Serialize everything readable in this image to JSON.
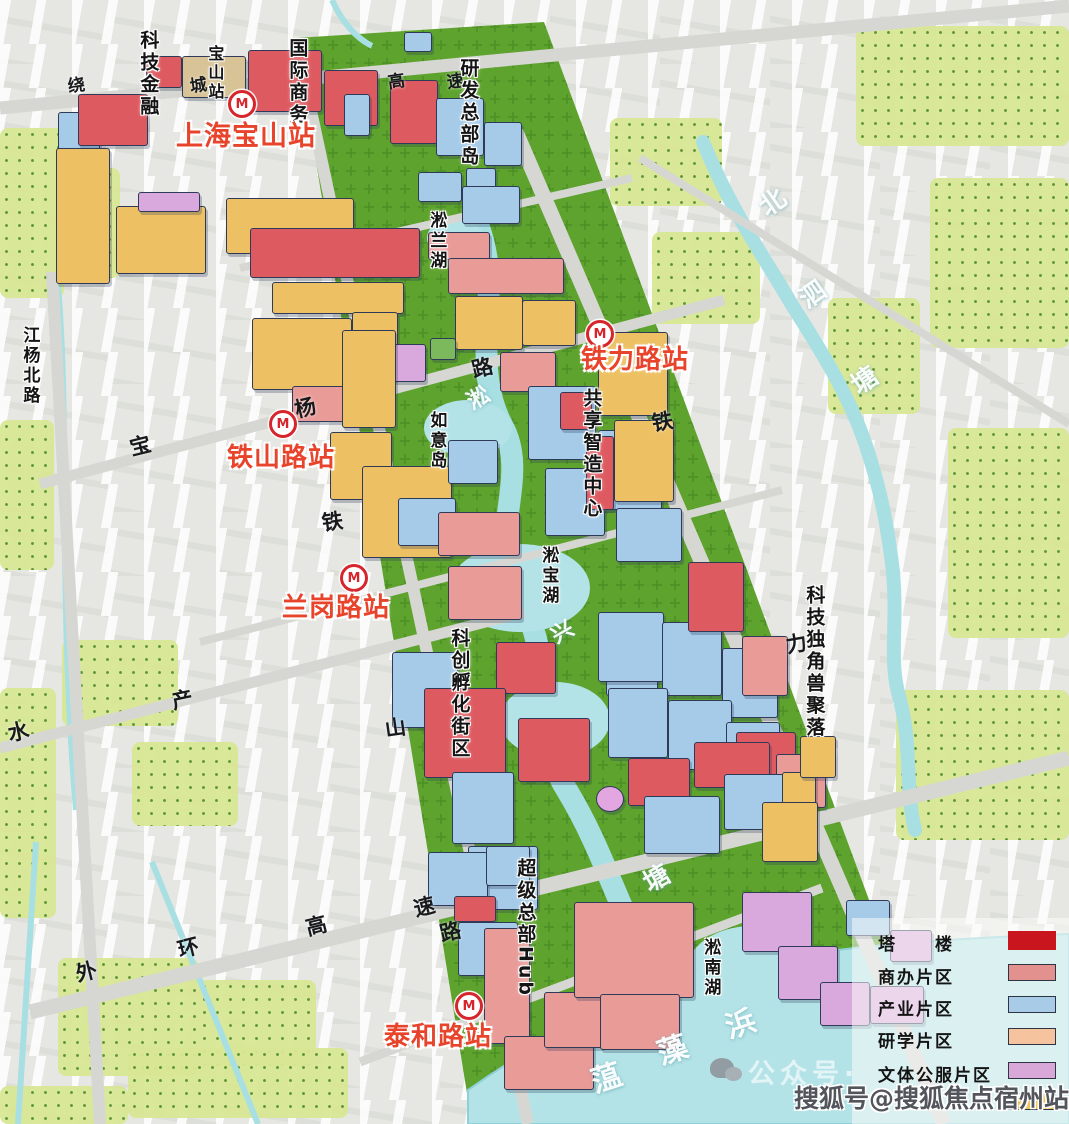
{
  "colors": {
    "tower_red": "#c9151e",
    "commercial_salmon": "#e2918f",
    "industry_blue": "#a8cce8",
    "research_peach": "#f5c39e",
    "culture_purple": "#d8a9d8",
    "yellow_block": "#edc163",
    "station_label_red": "#e8432b",
    "park_green": "#5ea32d",
    "water_cyan": "#b3e3e7"
  },
  "stations": [
    {
      "name": "上海宝山站",
      "icon": {
        "x": 242,
        "y": 104
      },
      "label": {
        "x": 176,
        "y": 123,
        "size": 27
      }
    },
    {
      "name": "铁力路站",
      "icon": {
        "x": 600,
        "y": 334
      },
      "label": {
        "x": 581,
        "y": 347,
        "size": 26
      }
    },
    {
      "name": "铁山路站",
      "icon": {
        "x": 283,
        "y": 424
      },
      "label": {
        "x": 227,
        "y": 445,
        "size": 26
      }
    },
    {
      "name": "兰岗路站",
      "icon": {
        "x": 354,
        "y": 578
      },
      "label": {
        "x": 282,
        "y": 595,
        "size": 26
      }
    },
    {
      "name": "泰和路站",
      "icon": {
        "x": 469,
        "y": 1006
      },
      "label": {
        "x": 384,
        "y": 1024,
        "size": 26
      }
    }
  ],
  "map": {
    "area_labels": [
      {
        "text": "科技金融",
        "x": 138,
        "y": 30,
        "size": 19
      },
      {
        "text": "宝山站",
        "x": 206,
        "y": 45,
        "size": 16
      },
      {
        "text": "国际商务",
        "x": 287,
        "y": 38,
        "size": 19
      },
      {
        "text": "研发总部岛",
        "x": 458,
        "y": 58,
        "size": 19
      },
      {
        "text": "淞兰湖",
        "x": 427,
        "y": 211,
        "size": 17
      },
      {
        "text": "如意岛",
        "x": 427,
        "y": 411,
        "size": 17
      },
      {
        "text": "共享智造中心",
        "x": 581,
        "y": 388,
        "size": 19
      },
      {
        "text": "淞宝湖",
        "x": 539,
        "y": 546,
        "size": 17
      },
      {
        "text": "科创孵化街区",
        "x": 449,
        "y": 628,
        "size": 19
      },
      {
        "text": "科技独角兽聚落",
        "x": 804,
        "y": 585,
        "size": 19
      },
      {
        "text": "超级总部Hub",
        "x": 515,
        "y": 858,
        "size": 19
      },
      {
        "text": "淞南湖",
        "x": 701,
        "y": 938,
        "size": 17
      },
      {
        "text": "江杨北路",
        "x": 20,
        "y": 326,
        "size": 17
      }
    ],
    "road_labels": [
      {
        "t": "绕",
        "x": 68,
        "y": 78,
        "r": -8,
        "s": 17
      },
      {
        "t": "城",
        "x": 190,
        "y": 78,
        "r": -8,
        "s": 17
      },
      {
        "t": "高",
        "x": 388,
        "y": 74,
        "r": -8,
        "s": 17
      },
      {
        "t": "速",
        "x": 447,
        "y": 74,
        "r": -8,
        "s": 17
      },
      {
        "t": "宝",
        "x": 130,
        "y": 436,
        "r": -14,
        "s": 21
      },
      {
        "t": "杨",
        "x": 295,
        "y": 398,
        "r": -14,
        "s": 21
      },
      {
        "t": "路",
        "x": 472,
        "y": 358,
        "r": -14,
        "s": 21
      },
      {
        "t": "铁",
        "x": 322,
        "y": 512,
        "r": -8,
        "s": 21
      },
      {
        "t": "山",
        "x": 385,
        "y": 718,
        "r": -8,
        "s": 21
      },
      {
        "t": "铁",
        "x": 652,
        "y": 412,
        "r": -10,
        "s": 21
      },
      {
        "t": "力",
        "x": 786,
        "y": 634,
        "r": -10,
        "s": 21
      },
      {
        "t": "水",
        "x": 8,
        "y": 722,
        "r": -12,
        "s": 21
      },
      {
        "t": "产",
        "x": 172,
        "y": 690,
        "r": -12,
        "s": 21
      },
      {
        "t": "外",
        "x": 76,
        "y": 962,
        "r": -14,
        "s": 21
      },
      {
        "t": "环",
        "x": 178,
        "y": 938,
        "r": -14,
        "s": 21
      },
      {
        "t": "高",
        "x": 306,
        "y": 916,
        "r": -14,
        "s": 21
      },
      {
        "t": "速",
        "x": 414,
        "y": 897,
        "r": -14,
        "s": 21
      },
      {
        "t": "路",
        "x": 440,
        "y": 922,
        "r": -14,
        "s": 21
      }
    ],
    "river_labels": [
      {
        "t": "北",
        "x": 760,
        "y": 190,
        "r": -35,
        "s": 26
      },
      {
        "t": "泗",
        "x": 800,
        "y": 282,
        "r": -35,
        "s": 26
      },
      {
        "t": "塘",
        "x": 852,
        "y": 368,
        "r": -35,
        "s": 26
      },
      {
        "t": "淞",
        "x": 468,
        "y": 388,
        "r": -30,
        "s": 22
      },
      {
        "t": "兴",
        "x": 552,
        "y": 622,
        "r": -30,
        "s": 22
      },
      {
        "t": "塘",
        "x": 644,
        "y": 866,
        "r": -30,
        "s": 26
      },
      {
        "t": "蕰",
        "x": 592,
        "y": 1064,
        "r": -18,
        "s": 30
      },
      {
        "t": "藻",
        "x": 658,
        "y": 1036,
        "r": -18,
        "s": 30
      },
      {
        "t": "浜",
        "x": 726,
        "y": 1010,
        "r": -18,
        "s": 30
      }
    ],
    "fields": [
      [
        0,
        128,
        64,
        170
      ],
      [
        64,
        168,
        56,
        110
      ],
      [
        0,
        420,
        54,
        150
      ],
      [
        0,
        688,
        56,
        230
      ],
      [
        62,
        640,
        116,
        86
      ],
      [
        132,
        742,
        106,
        84
      ],
      [
        58,
        958,
        140,
        118
      ],
      [
        198,
        980,
        118,
        86
      ],
      [
        128,
        1048,
        220,
        70
      ],
      [
        856,
        26,
        213,
        120
      ],
      [
        930,
        178,
        139,
        170
      ],
      [
        828,
        298,
        92,
        116
      ],
      [
        948,
        428,
        121,
        210
      ],
      [
        896,
        690,
        173,
        150
      ],
      [
        0,
        1086,
        128,
        38
      ],
      [
        610,
        118,
        112,
        88
      ],
      [
        652,
        232,
        108,
        92
      ]
    ],
    "buildings": [
      [
        58,
        112,
        42,
        46,
        "B"
      ],
      [
        78,
        94,
        70,
        52,
        "R"
      ],
      [
        146,
        56,
        36,
        32,
        "R"
      ],
      [
        182,
        56,
        64,
        42,
        "T"
      ],
      [
        248,
        50,
        74,
        62,
        "R"
      ],
      [
        324,
        70,
        54,
        56,
        "R"
      ],
      [
        390,
        80,
        48,
        64,
        "R"
      ],
      [
        344,
        94,
        26,
        42,
        "B"
      ],
      [
        404,
        32,
        28,
        20,
        "B"
      ],
      [
        436,
        98,
        48,
        58,
        "B"
      ],
      [
        484,
        122,
        38,
        44,
        "B"
      ],
      [
        466,
        168,
        30,
        40,
        "B"
      ],
      [
        56,
        148,
        54,
        136,
        "Y"
      ],
      [
        116,
        206,
        90,
        68,
        "Y"
      ],
      [
        226,
        198,
        128,
        56,
        "Y"
      ],
      [
        138,
        192,
        62,
        20,
        "P"
      ],
      [
        250,
        228,
        170,
        50,
        "R"
      ],
      [
        272,
        282,
        132,
        32,
        "Y"
      ],
      [
        252,
        318,
        100,
        72,
        "Y"
      ],
      [
        352,
        312,
        46,
        62,
        "Y"
      ],
      [
        418,
        172,
        44,
        30,
        "B"
      ],
      [
        462,
        186,
        58,
        38,
        "B"
      ],
      [
        428,
        232,
        62,
        28,
        "S"
      ],
      [
        448,
        258,
        116,
        36,
        "S"
      ],
      [
        455,
        296,
        68,
        54,
        "Y"
      ],
      [
        522,
        300,
        54,
        46,
        "Y"
      ],
      [
        378,
        344,
        48,
        38,
        "P"
      ],
      [
        430,
        338,
        26,
        22,
        "G"
      ],
      [
        292,
        386,
        64,
        36,
        "S"
      ],
      [
        500,
        352,
        56,
        40,
        "S"
      ],
      [
        342,
        330,
        54,
        98,
        "Y"
      ],
      [
        330,
        432,
        62,
        68,
        "Y"
      ],
      [
        362,
        466,
        90,
        92,
        "Y"
      ],
      [
        448,
        440,
        50,
        44,
        "B"
      ],
      [
        398,
        498,
        58,
        48,
        "B"
      ],
      [
        438,
        512,
        82,
        44,
        "S"
      ],
      [
        448,
        566,
        74,
        54,
        "S"
      ],
      [
        528,
        386,
        68,
        74,
        "B"
      ],
      [
        598,
        430,
        64,
        80,
        "B"
      ],
      [
        545,
        468,
        60,
        68,
        "B"
      ],
      [
        616,
        508,
        66,
        54,
        "B"
      ],
      [
        560,
        392,
        32,
        38,
        "R"
      ],
      [
        586,
        436,
        28,
        74,
        "R"
      ],
      [
        598,
        332,
        70,
        84,
        "Y"
      ],
      [
        614,
        420,
        60,
        82,
        "Y"
      ],
      [
        606,
        624,
        52,
        72,
        "B"
      ],
      [
        392,
        652,
        66,
        76,
        "B"
      ],
      [
        496,
        642,
        60,
        52,
        "R"
      ],
      [
        424,
        688,
        82,
        90,
        "R"
      ],
      [
        518,
        718,
        72,
        64,
        "R"
      ],
      [
        452,
        772,
        62,
        72,
        "B"
      ],
      [
        468,
        846,
        70,
        64,
        "B"
      ],
      [
        598,
        612,
        66,
        70,
        "B"
      ],
      [
        662,
        622,
        60,
        74,
        "B"
      ],
      [
        722,
        648,
        56,
        70,
        "B"
      ],
      [
        608,
        688,
        60,
        70,
        "B"
      ],
      [
        668,
        700,
        64,
        70,
        "B"
      ],
      [
        726,
        722,
        54,
        64,
        "B"
      ],
      [
        688,
        562,
        56,
        70,
        "R"
      ],
      [
        742,
        636,
        46,
        60,
        "S"
      ],
      [
        736,
        732,
        60,
        64,
        "R"
      ],
      [
        776,
        754,
        50,
        54,
        "S"
      ],
      [
        628,
        758,
        62,
        48,
        "R"
      ],
      [
        694,
        742,
        76,
        46,
        "R"
      ],
      [
        644,
        796,
        76,
        58,
        "B"
      ],
      [
        724,
        774,
        60,
        56,
        "B"
      ],
      [
        782,
        772,
        34,
        36,
        "Y"
      ],
      [
        800,
        736,
        36,
        42,
        "Y"
      ],
      [
        762,
        802,
        56,
        60,
        "Y"
      ],
      [
        596,
        786,
        28,
        26,
        "Pc"
      ],
      [
        428,
        852,
        60,
        54,
        "B"
      ],
      [
        486,
        846,
        44,
        40,
        "B"
      ],
      [
        454,
        896,
        42,
        26,
        "R"
      ],
      [
        458,
        922,
        60,
        54,
        "B"
      ],
      [
        484,
        928,
        46,
        116,
        "S"
      ],
      [
        504,
        1036,
        90,
        54,
        "S"
      ],
      [
        544,
        992,
        60,
        56,
        "S"
      ],
      [
        574,
        902,
        120,
        96,
        "S"
      ],
      [
        600,
        994,
        80,
        56,
        "S"
      ],
      [
        742,
        892,
        70,
        60,
        "P"
      ],
      [
        778,
        946,
        60,
        54,
        "P"
      ],
      [
        820,
        982,
        50,
        44,
        "P"
      ],
      [
        870,
        986,
        54,
        38,
        "P"
      ],
      [
        890,
        930,
        42,
        32,
        "P"
      ],
      [
        846,
        900,
        44,
        36,
        "B"
      ]
    ]
  },
  "legend": {
    "row_y": [
      12,
      45,
      77,
      109,
      143,
      174
    ],
    "items": [
      {
        "label": "塔　　楼",
        "color": "#c9151e",
        "bordered": false
      },
      {
        "label": "商办片区",
        "color": "#e2918f",
        "bordered": true
      },
      {
        "label": "产业片区",
        "color": "#a8cce8",
        "bordered": true
      },
      {
        "label": "研学片区",
        "color": "#f5c39e",
        "bordered": true
      },
      {
        "label": "文体公服片区",
        "color": "#d8a9d8",
        "bordered": true
      },
      {
        "label": "",
        "color": "#efc75f",
        "bordered": true
      }
    ]
  },
  "watermarks": {
    "sohu": "搜狐号@搜狐焦点宿州站",
    "wechat": "公众号·"
  }
}
